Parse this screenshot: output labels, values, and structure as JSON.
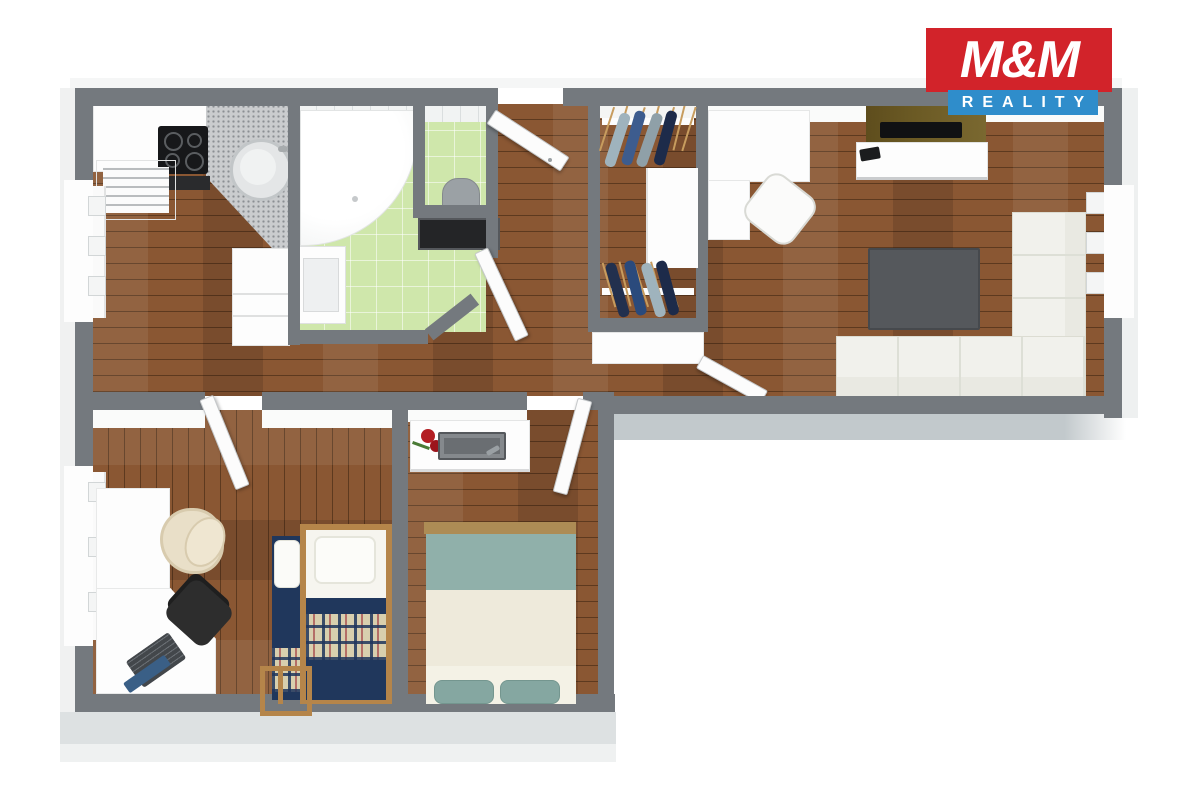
{
  "logo": {
    "title": "M&M",
    "subtitle": "REALITY"
  },
  "palette": {
    "wall": "#74797e",
    "outer-band": "#c2c9cc",
    "floor": "#8a5733",
    "tile": "#cfe7ab",
    "counter": "#caccce",
    "navy": "#20375c",
    "plaid": "#d8cfae",
    "teal": "#90b0aa",
    "cream": "#eeeadb",
    "sofa": "#f1f1ec",
    "table-dark": "#55585c",
    "tv-panel": "#6b5a24",
    "wood-frame": "#b5854a",
    "chair-black": "#2d2d2d",
    "armchair": "#e9dfc8",
    "logo-red": "#d2232a",
    "logo-blue": "#2f8dcb"
  }
}
